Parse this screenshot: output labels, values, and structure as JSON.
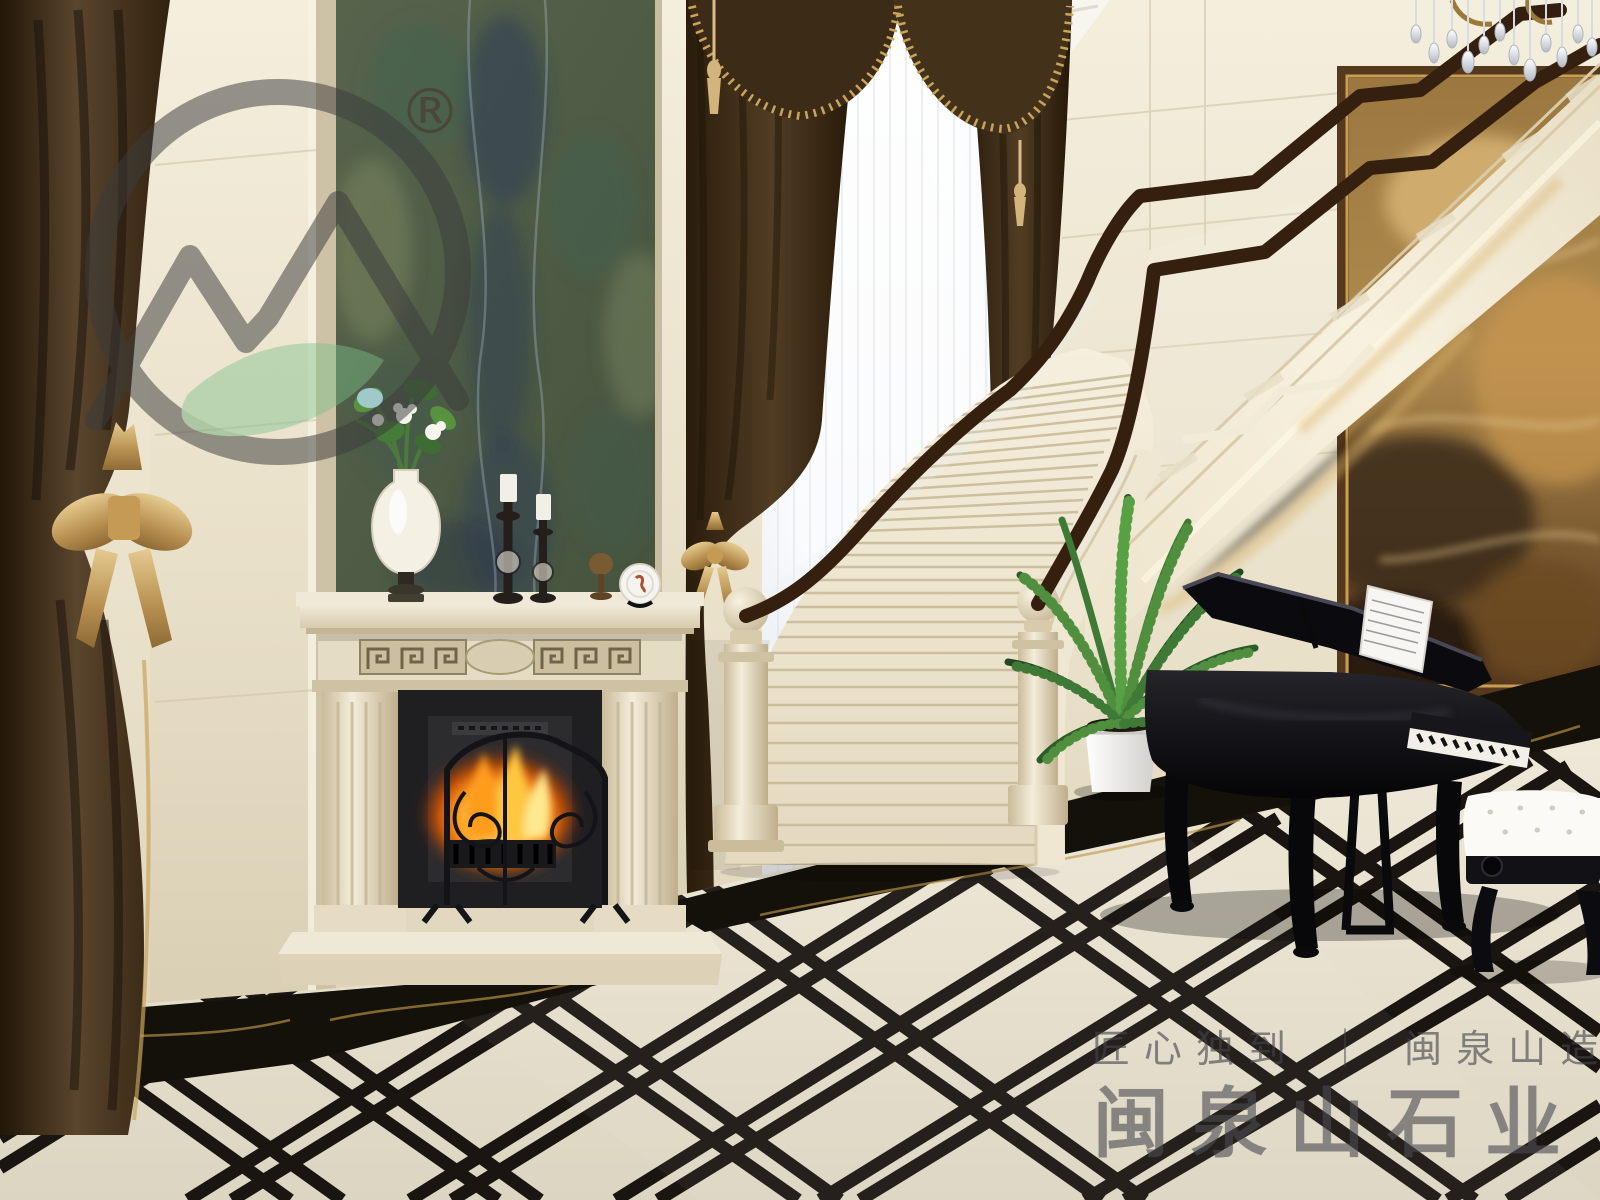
{
  "branding": {
    "registered_symbol": "®",
    "tagline": "匠心独到 ｜ 闽泉山造",
    "brand_name": "闽泉山石业"
  },
  "watermark": {
    "icon": "mountain-leaf-circle-logo",
    "ring_color": "#3d3d3d",
    "leaf_color": "#7cc08b"
  },
  "palette": {
    "wall_cream": "#ece4cf",
    "green_marble": "#53614b",
    "drapery_brown": "#4a3723",
    "gold_accent": "#c9a45c",
    "stair_cream": "#f0e8d3",
    "handrail_wood": "#36200f",
    "floor_inlay_black": "#1a1510",
    "piano_black": "#0b0b0e",
    "fire_glow": "#ff9c1c"
  },
  "objects": [
    "brown-drapery",
    "green-marble-feature-wall",
    "marble-fireplace",
    "fire-screen",
    "mantel-vase-with-flowers",
    "candlesticks",
    "decorative-plate",
    "sheer-window",
    "curved-marble-staircase",
    "wood-handrail",
    "glass-balustrade",
    "potted-fern",
    "grand-piano",
    "piano-bench",
    "abstract-painting",
    "crystal-chandelier",
    "marble-inlay-floor",
    "black-marble-border"
  ]
}
